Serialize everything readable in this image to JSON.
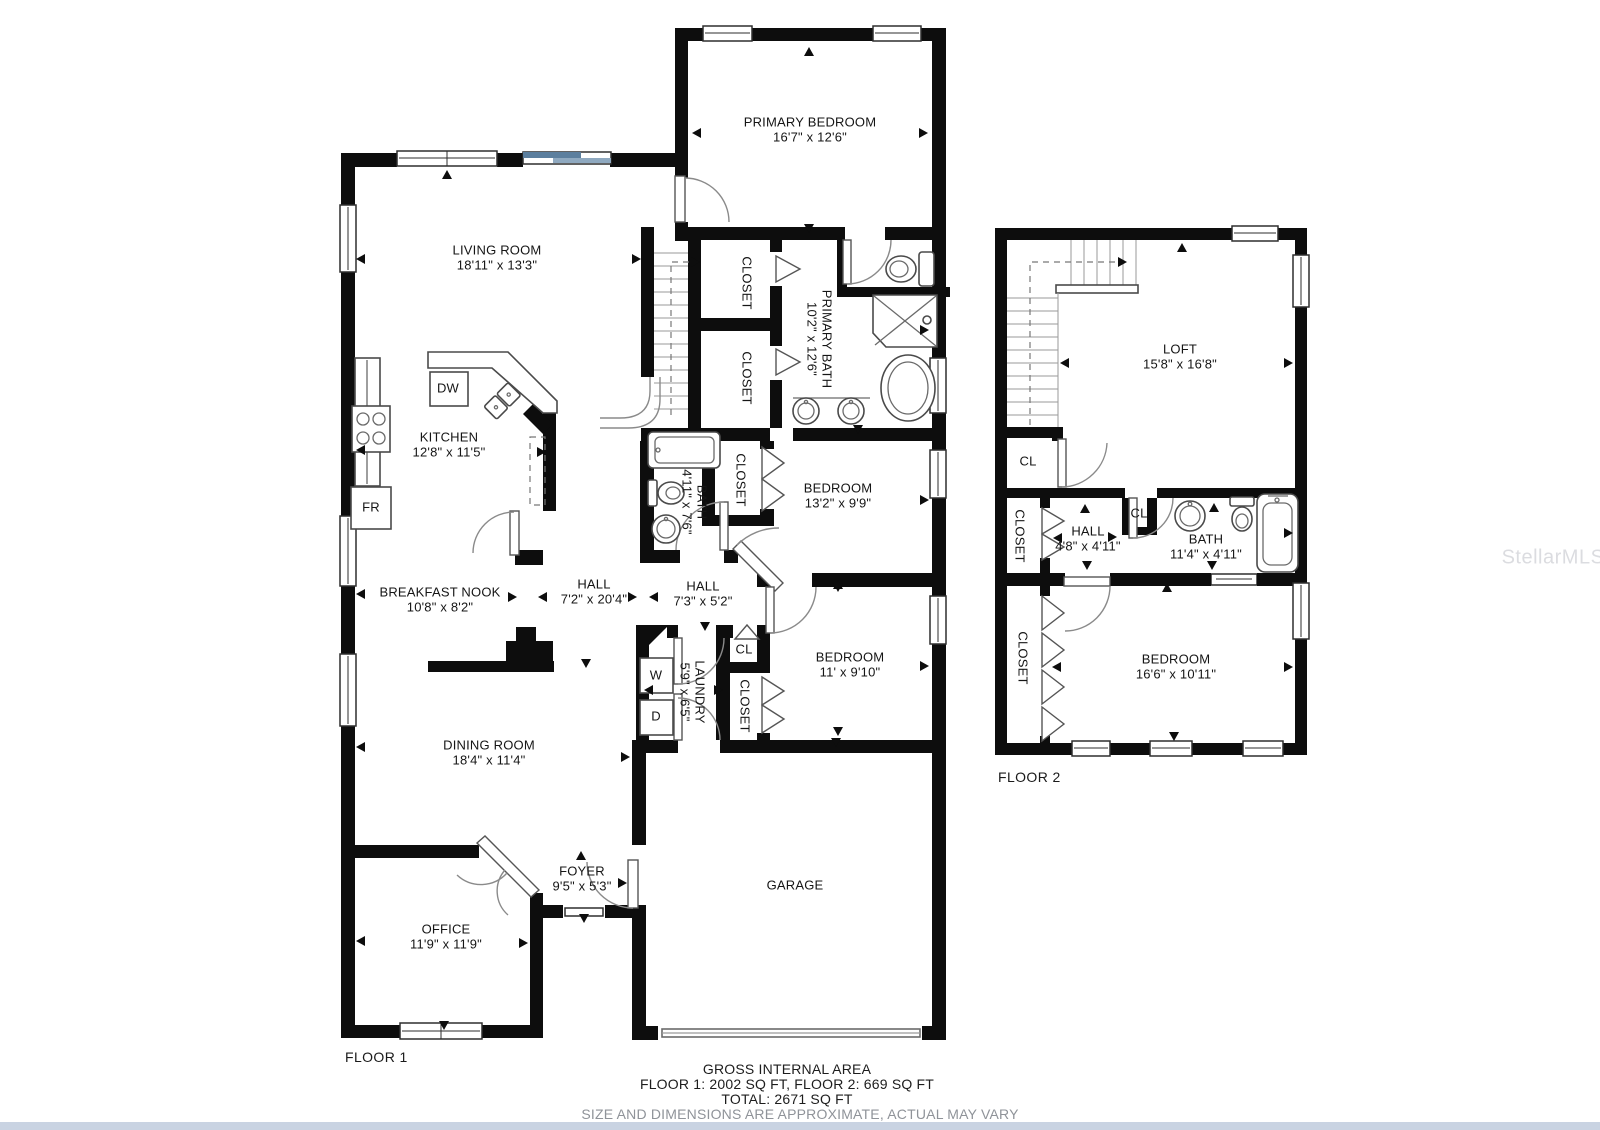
{
  "watermark": "StellarMLS",
  "floor1": {
    "label": "FLOOR 1",
    "rooms": {
      "primary_bedroom": {
        "name": "PRIMARY BEDROOM",
        "dims": "16'7\" x 12'6\""
      },
      "living_room": {
        "name": "LIVING ROOM",
        "dims": "18'11\" x 13'3\""
      },
      "kitchen": {
        "name": "KITCHEN",
        "dims": "12'8\" x 11'5\""
      },
      "breakfast_nook": {
        "name": "BREAKFAST NOOK",
        "dims": "10'8\" x 8'2\""
      },
      "hall_main": {
        "name": "HALL",
        "dims": "7'2\" x 20'4\""
      },
      "hall_small": {
        "name": "HALL",
        "dims": "7'3\" x 5'2\""
      },
      "primary_bath": {
        "name": "PRIMARY BATH",
        "dims": "10'2\" x 12'6\""
      },
      "bath": {
        "name": "BATH",
        "dims": "4'11\" x 7'6\""
      },
      "bedroom_a": {
        "name": "BEDROOM",
        "dims": "13'2\" x 9'9\""
      },
      "bedroom_b": {
        "name": "BEDROOM",
        "dims": "11' x 9'10\""
      },
      "laundry": {
        "name": "LAUNDRY",
        "dims": "5'9\" x 6'5\""
      },
      "dining_room": {
        "name": "DINING ROOM",
        "dims": "18'4\" x 11'4\""
      },
      "office": {
        "name": "OFFICE",
        "dims": "11'9\" x 11'9\""
      },
      "foyer": {
        "name": "FOYER",
        "dims": "9'5\" x 5'3\""
      },
      "garage": {
        "name": "GARAGE"
      }
    },
    "labels": {
      "closet": "CLOSET",
      "cl": "CL",
      "dw": "DW",
      "fr": "FR",
      "washer": "W",
      "dryer": "D"
    }
  },
  "floor2": {
    "label": "FLOOR 2",
    "rooms": {
      "loft": {
        "name": "LOFT",
        "dims": "15'8\" x 16'8\""
      },
      "hall": {
        "name": "HALL",
        "dims": "4'8\" x 4'11\""
      },
      "bath": {
        "name": "BATH",
        "dims": "11'4\" x 4'11\""
      },
      "bedroom": {
        "name": "BEDROOM",
        "dims": "16'6\" x 10'11\""
      }
    },
    "labels": {
      "closet": "CLOSET",
      "cl": "CL"
    }
  },
  "footer": {
    "line1": "GROSS INTERNAL AREA",
    "line2": "FLOOR 1: 2002 SQ FT, FLOOR 2: 669 SQ FT",
    "line3": "TOTAL: 2671 SQ FT",
    "line4": "SIZE AND DIMENSIONS ARE APPROXIMATE, ACTUAL MAY VARY"
  }
}
